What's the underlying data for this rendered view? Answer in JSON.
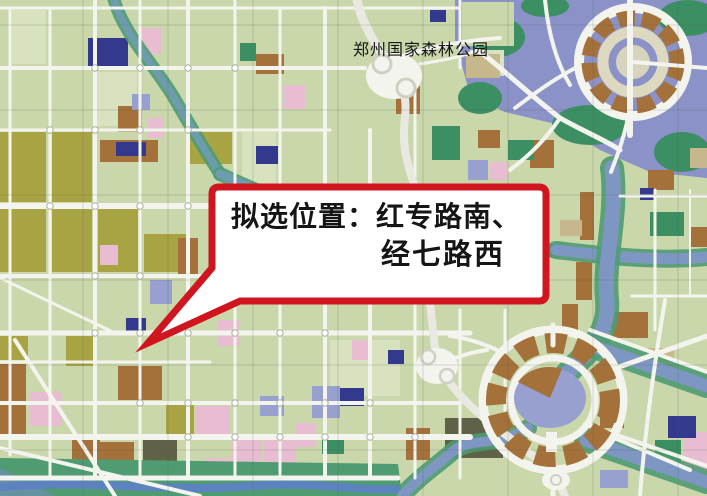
{
  "map": {
    "park_label": "郑州国家森林公园",
    "callout": {
      "line1": "拟选位置：红专路南、",
      "line2": "经七路西"
    }
  },
  "colors": {
    "callout_red": "#d0151f",
    "callout_white": "#ffffff",
    "ink": "#151515",
    "base_green": "#c9d7ab",
    "pale_green": "#d8e2bf",
    "olive": "#a9a443",
    "brown": "#a5713a",
    "pink": "#e8bdd2",
    "navy": "#333a8e",
    "periwinkle": "#98a0cf",
    "dark_green": "#3b8f63",
    "dark_olive": "#5f6247",
    "tan": "#c6b78c",
    "lake_blue": "#8a92c8",
    "band_green": "#4f9b72",
    "river_teal": "#6d9cae",
    "canal_blue": "#7e96c2",
    "road_white": "#f4f4ee",
    "highway": "#e9e9e1"
  }
}
